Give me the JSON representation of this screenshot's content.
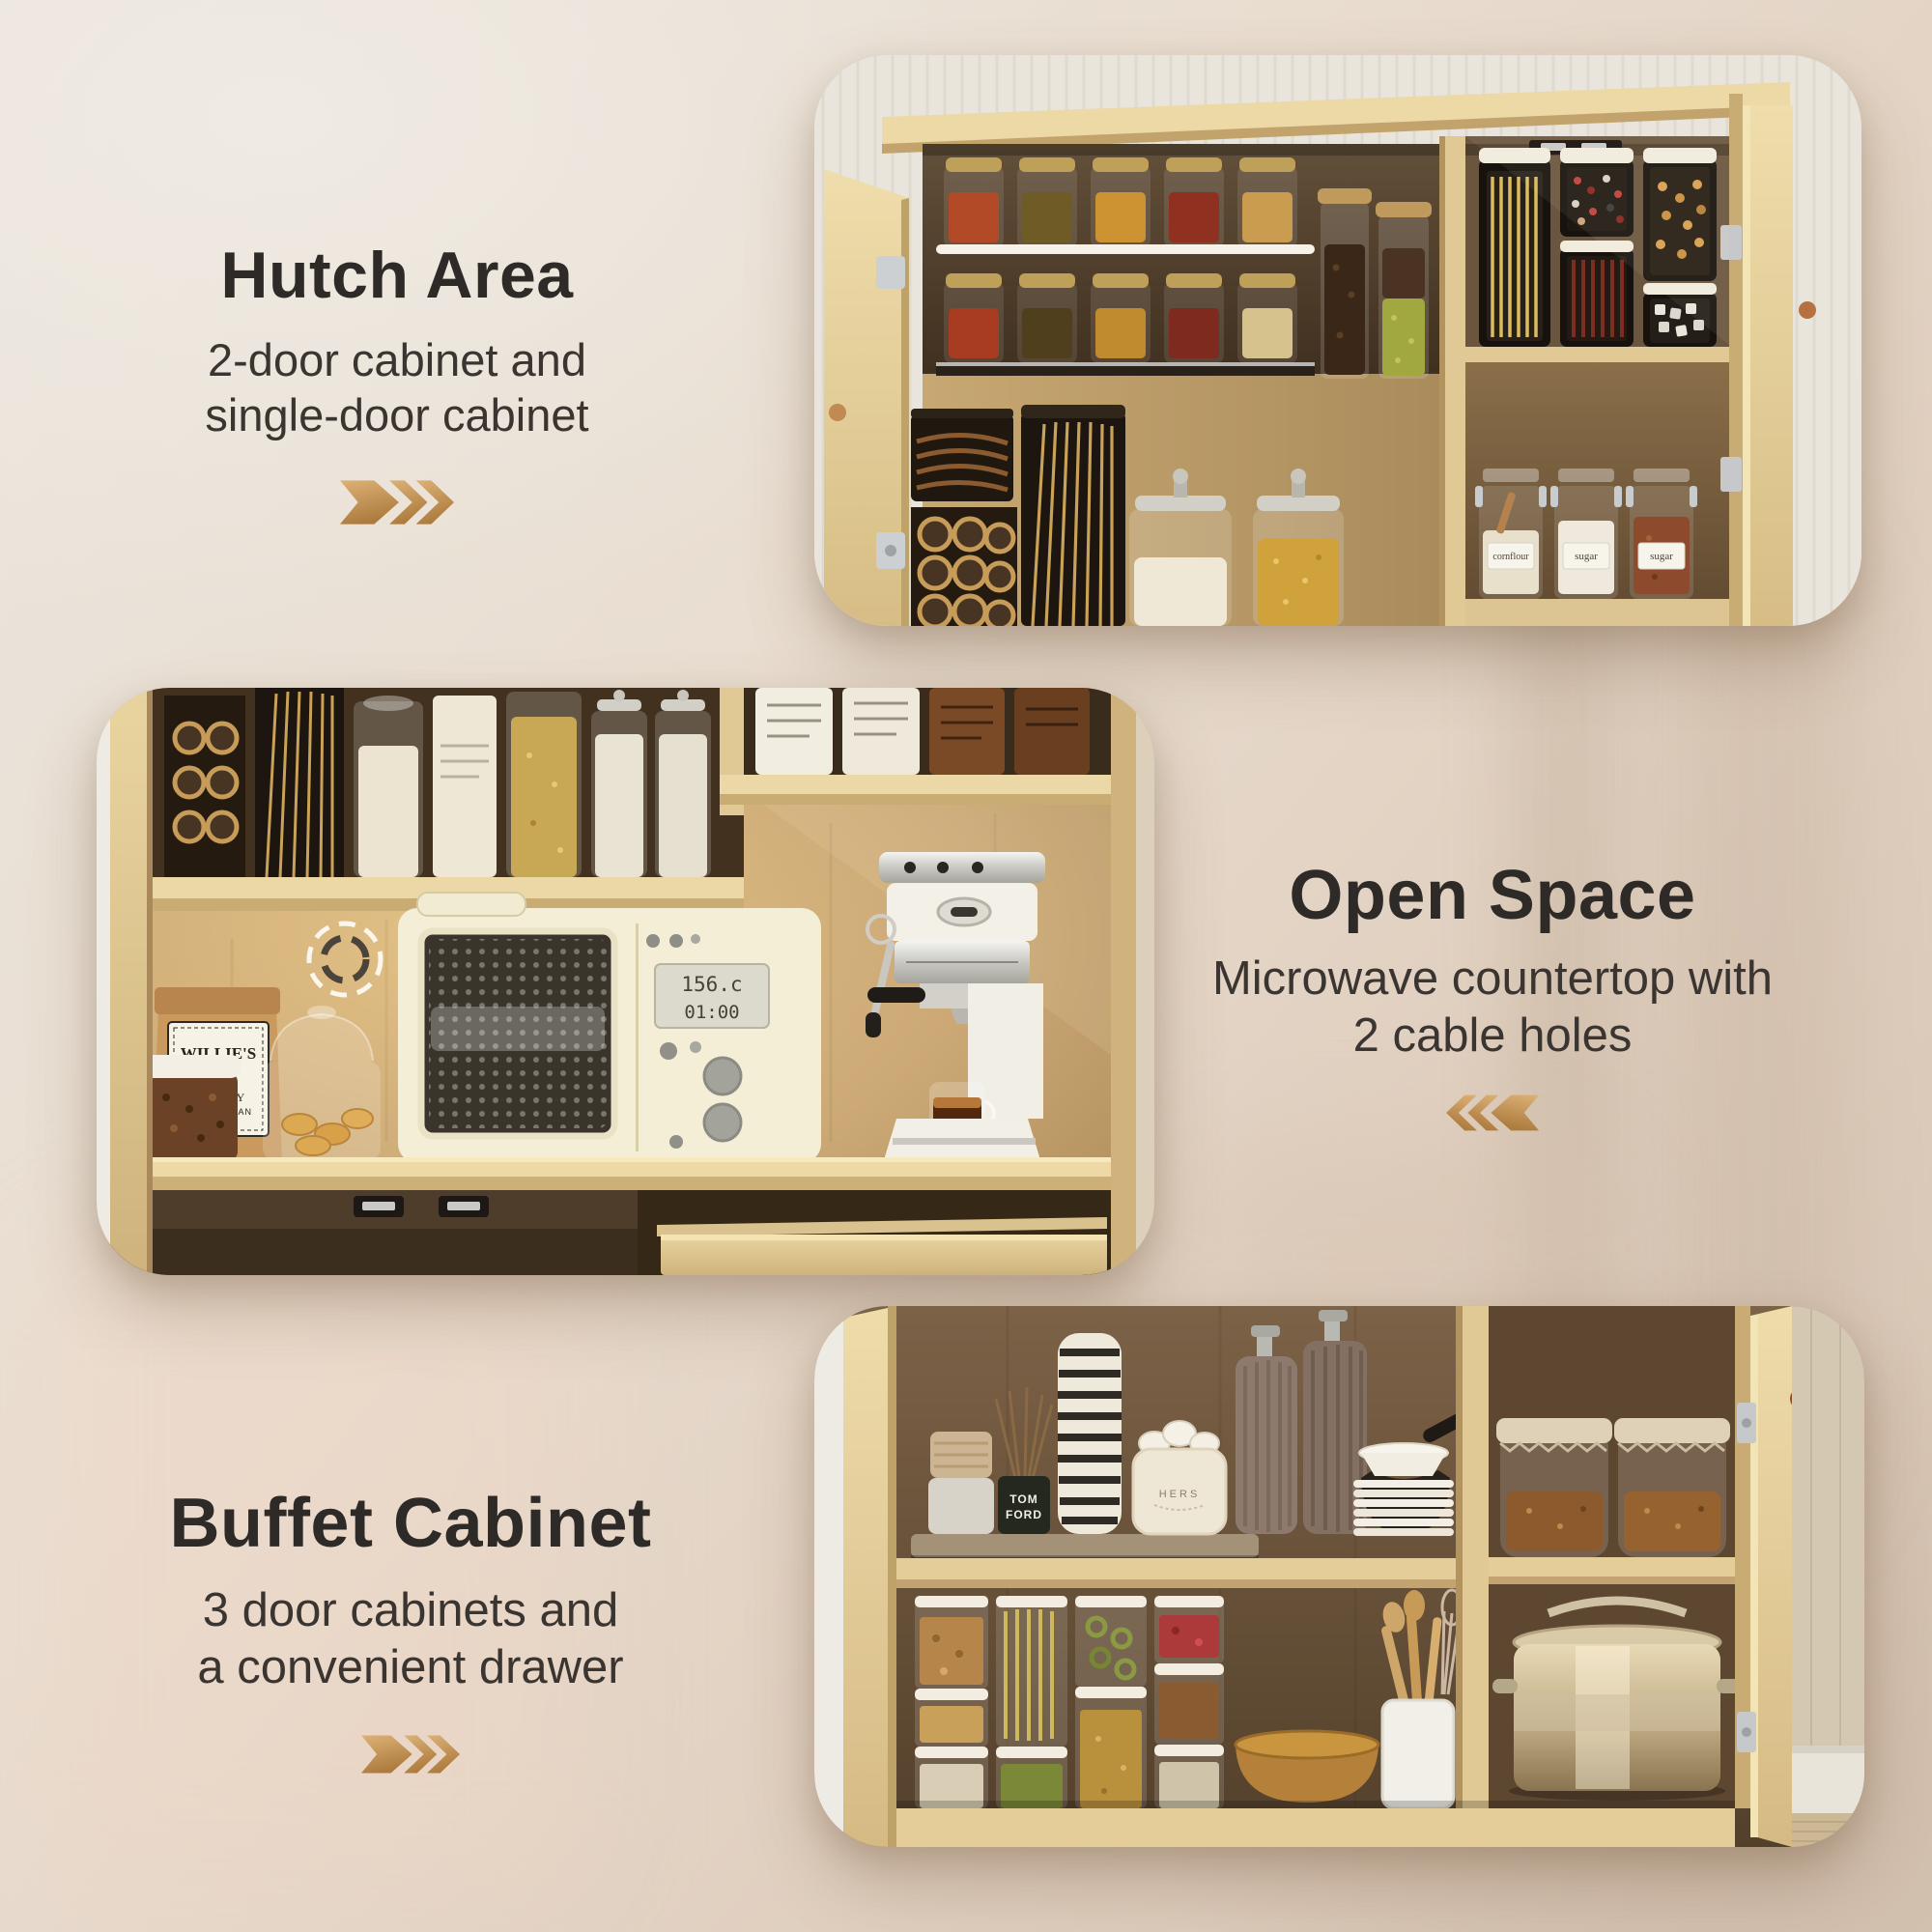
{
  "page": {
    "background_top_left": "#ebe6de",
    "background_bottom_right": "#d6c3b2"
  },
  "colors": {
    "title": "#2e2a27",
    "subtitle": "#3b3531",
    "arrow_gold_light": "#ddb277",
    "arrow_gold_dark": "#ad7b3e"
  },
  "sections": [
    {
      "id": "hutch-area",
      "title": "Hutch Area",
      "subtitle_line1": "2-door cabinet and",
      "subtitle_line2": "single-door cabinet",
      "arrow_direction": "right"
    },
    {
      "id": "open-space",
      "title": "Open Space",
      "subtitle_line1": "Microwave countertop with",
      "subtitle_line2": "2 cable holes",
      "arrow_direction": "left"
    },
    {
      "id": "buffet-cabinet",
      "title": "Buffet Cabinet",
      "subtitle_line1": "3 door cabinets and",
      "subtitle_line2": "a convenient drawer",
      "arrow_direction": "right"
    }
  ],
  "photos": {
    "hutch": {
      "name": "hutch-cabinet-photo",
      "jar_labels": [
        "cornflour",
        "sugar",
        "sugar"
      ]
    },
    "open_space": {
      "name": "open-space-countertop-photo",
      "microwave_display": [
        "156.c",
        "01:00"
      ],
      "coffee_bag_label": [
        "WILLIE'S",
        "REMEDY",
        "WHOLE BEAN",
        "COFFEE"
      ]
    },
    "buffet": {
      "name": "buffet-cabinet-photo",
      "bottle_label": [
        "TOM",
        "FORD"
      ],
      "basket_label": "HERS"
    }
  }
}
